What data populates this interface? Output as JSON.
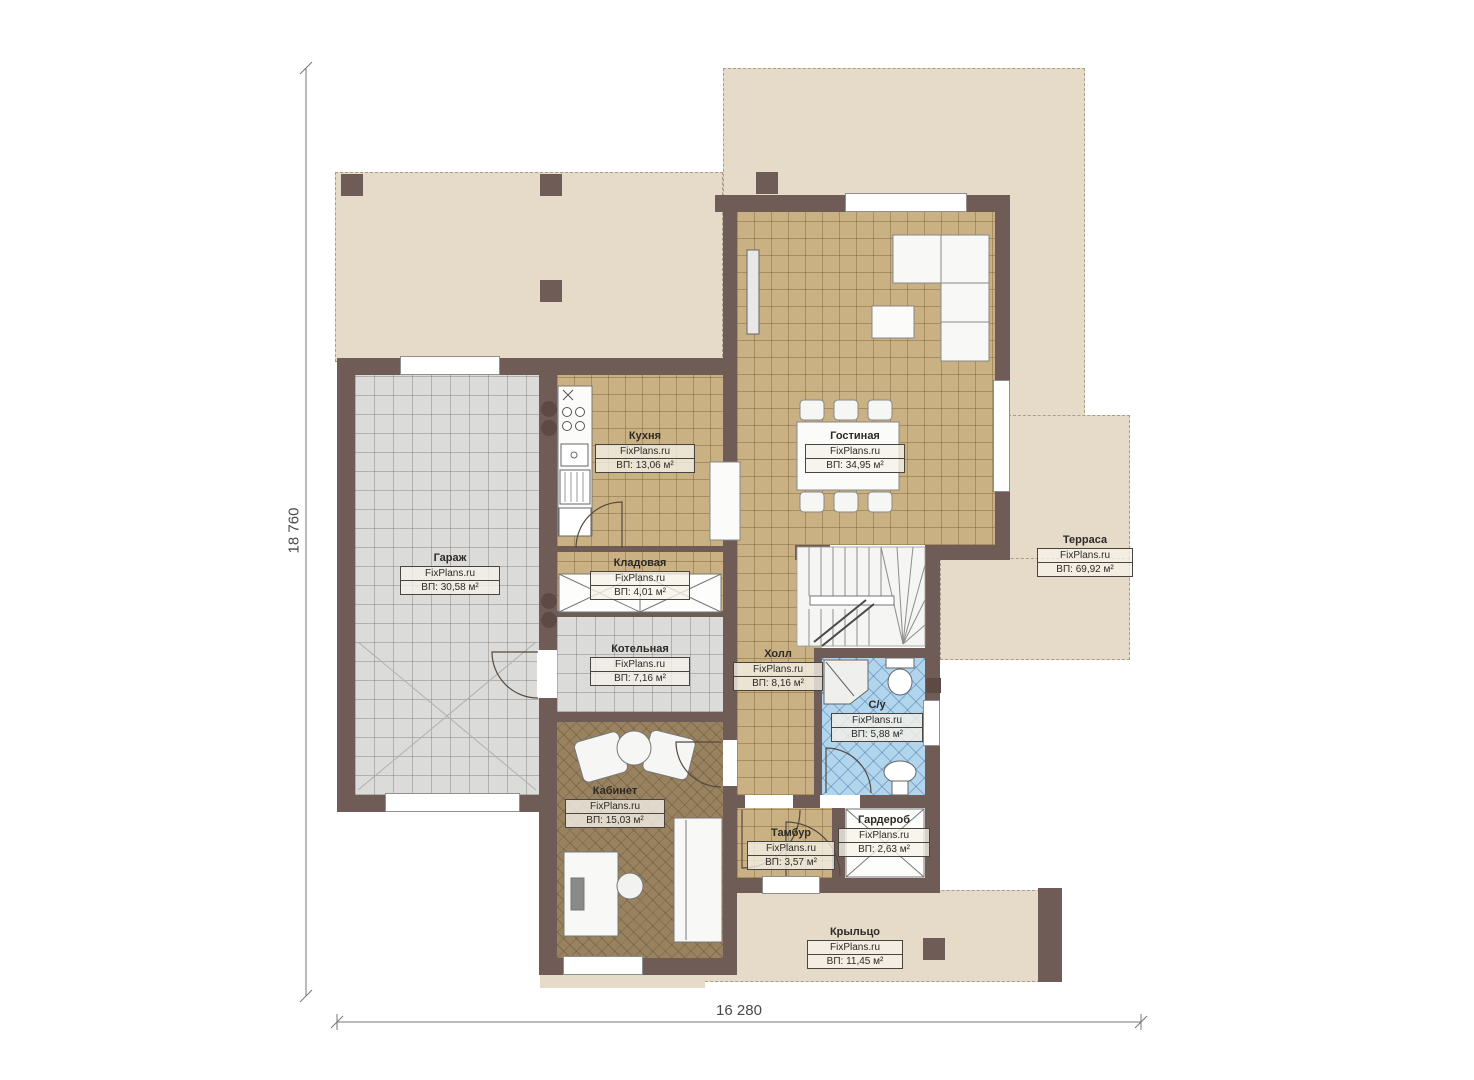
{
  "plan": {
    "dimensions": {
      "height": "18 760",
      "width": "16 280"
    },
    "rooms": [
      {
        "id": "garage",
        "name": "Гараж",
        "source": "FixPlans.ru",
        "area": "ВП: 30,58 м²"
      },
      {
        "id": "kitchen",
        "name": "Кухня",
        "source": "FixPlans.ru",
        "area": "ВП: 13,06 м²"
      },
      {
        "id": "living",
        "name": "Гостиная",
        "source": "FixPlans.ru",
        "area": "ВП: 34,95 м²"
      },
      {
        "id": "storage",
        "name": "Кладовая",
        "source": "FixPlans.ru",
        "area": "ВП: 4,01 м²"
      },
      {
        "id": "boiler",
        "name": "Котельная",
        "source": "FixPlans.ru",
        "area": "ВП: 7,16 м²"
      },
      {
        "id": "hall",
        "name": "Холл",
        "source": "FixPlans.ru",
        "area": "ВП: 8,16 м²"
      },
      {
        "id": "wc",
        "name": "С/у",
        "source": "FixPlans.ru",
        "area": "ВП: 5,88 м²"
      },
      {
        "id": "office",
        "name": "Кабинет",
        "source": "FixPlans.ru",
        "area": "ВП: 15,03 м²"
      },
      {
        "id": "tambour",
        "name": "Тамбур",
        "source": "FixPlans.ru",
        "area": "ВП: 3,57 м²"
      },
      {
        "id": "wardrobe",
        "name": "Гардероб",
        "source": "FixPlans.ru",
        "area": "ВП: 2,63 м²"
      },
      {
        "id": "terrace",
        "name": "Терраса",
        "source": "FixPlans.ru",
        "area": "ВП: 69,92 м²"
      },
      {
        "id": "porch",
        "name": "Крыльцо",
        "source": "FixPlans.ru",
        "area": "ВП: 11,45 м²"
      }
    ],
    "colors": {
      "wall": "#6f5c57",
      "terrace": "#e6dbc9",
      "tile_tan": "#c9b183",
      "tile_gray": "#dbdbd9",
      "tile_blue": "#b2d5ee",
      "office_floor": "#98825f"
    }
  }
}
